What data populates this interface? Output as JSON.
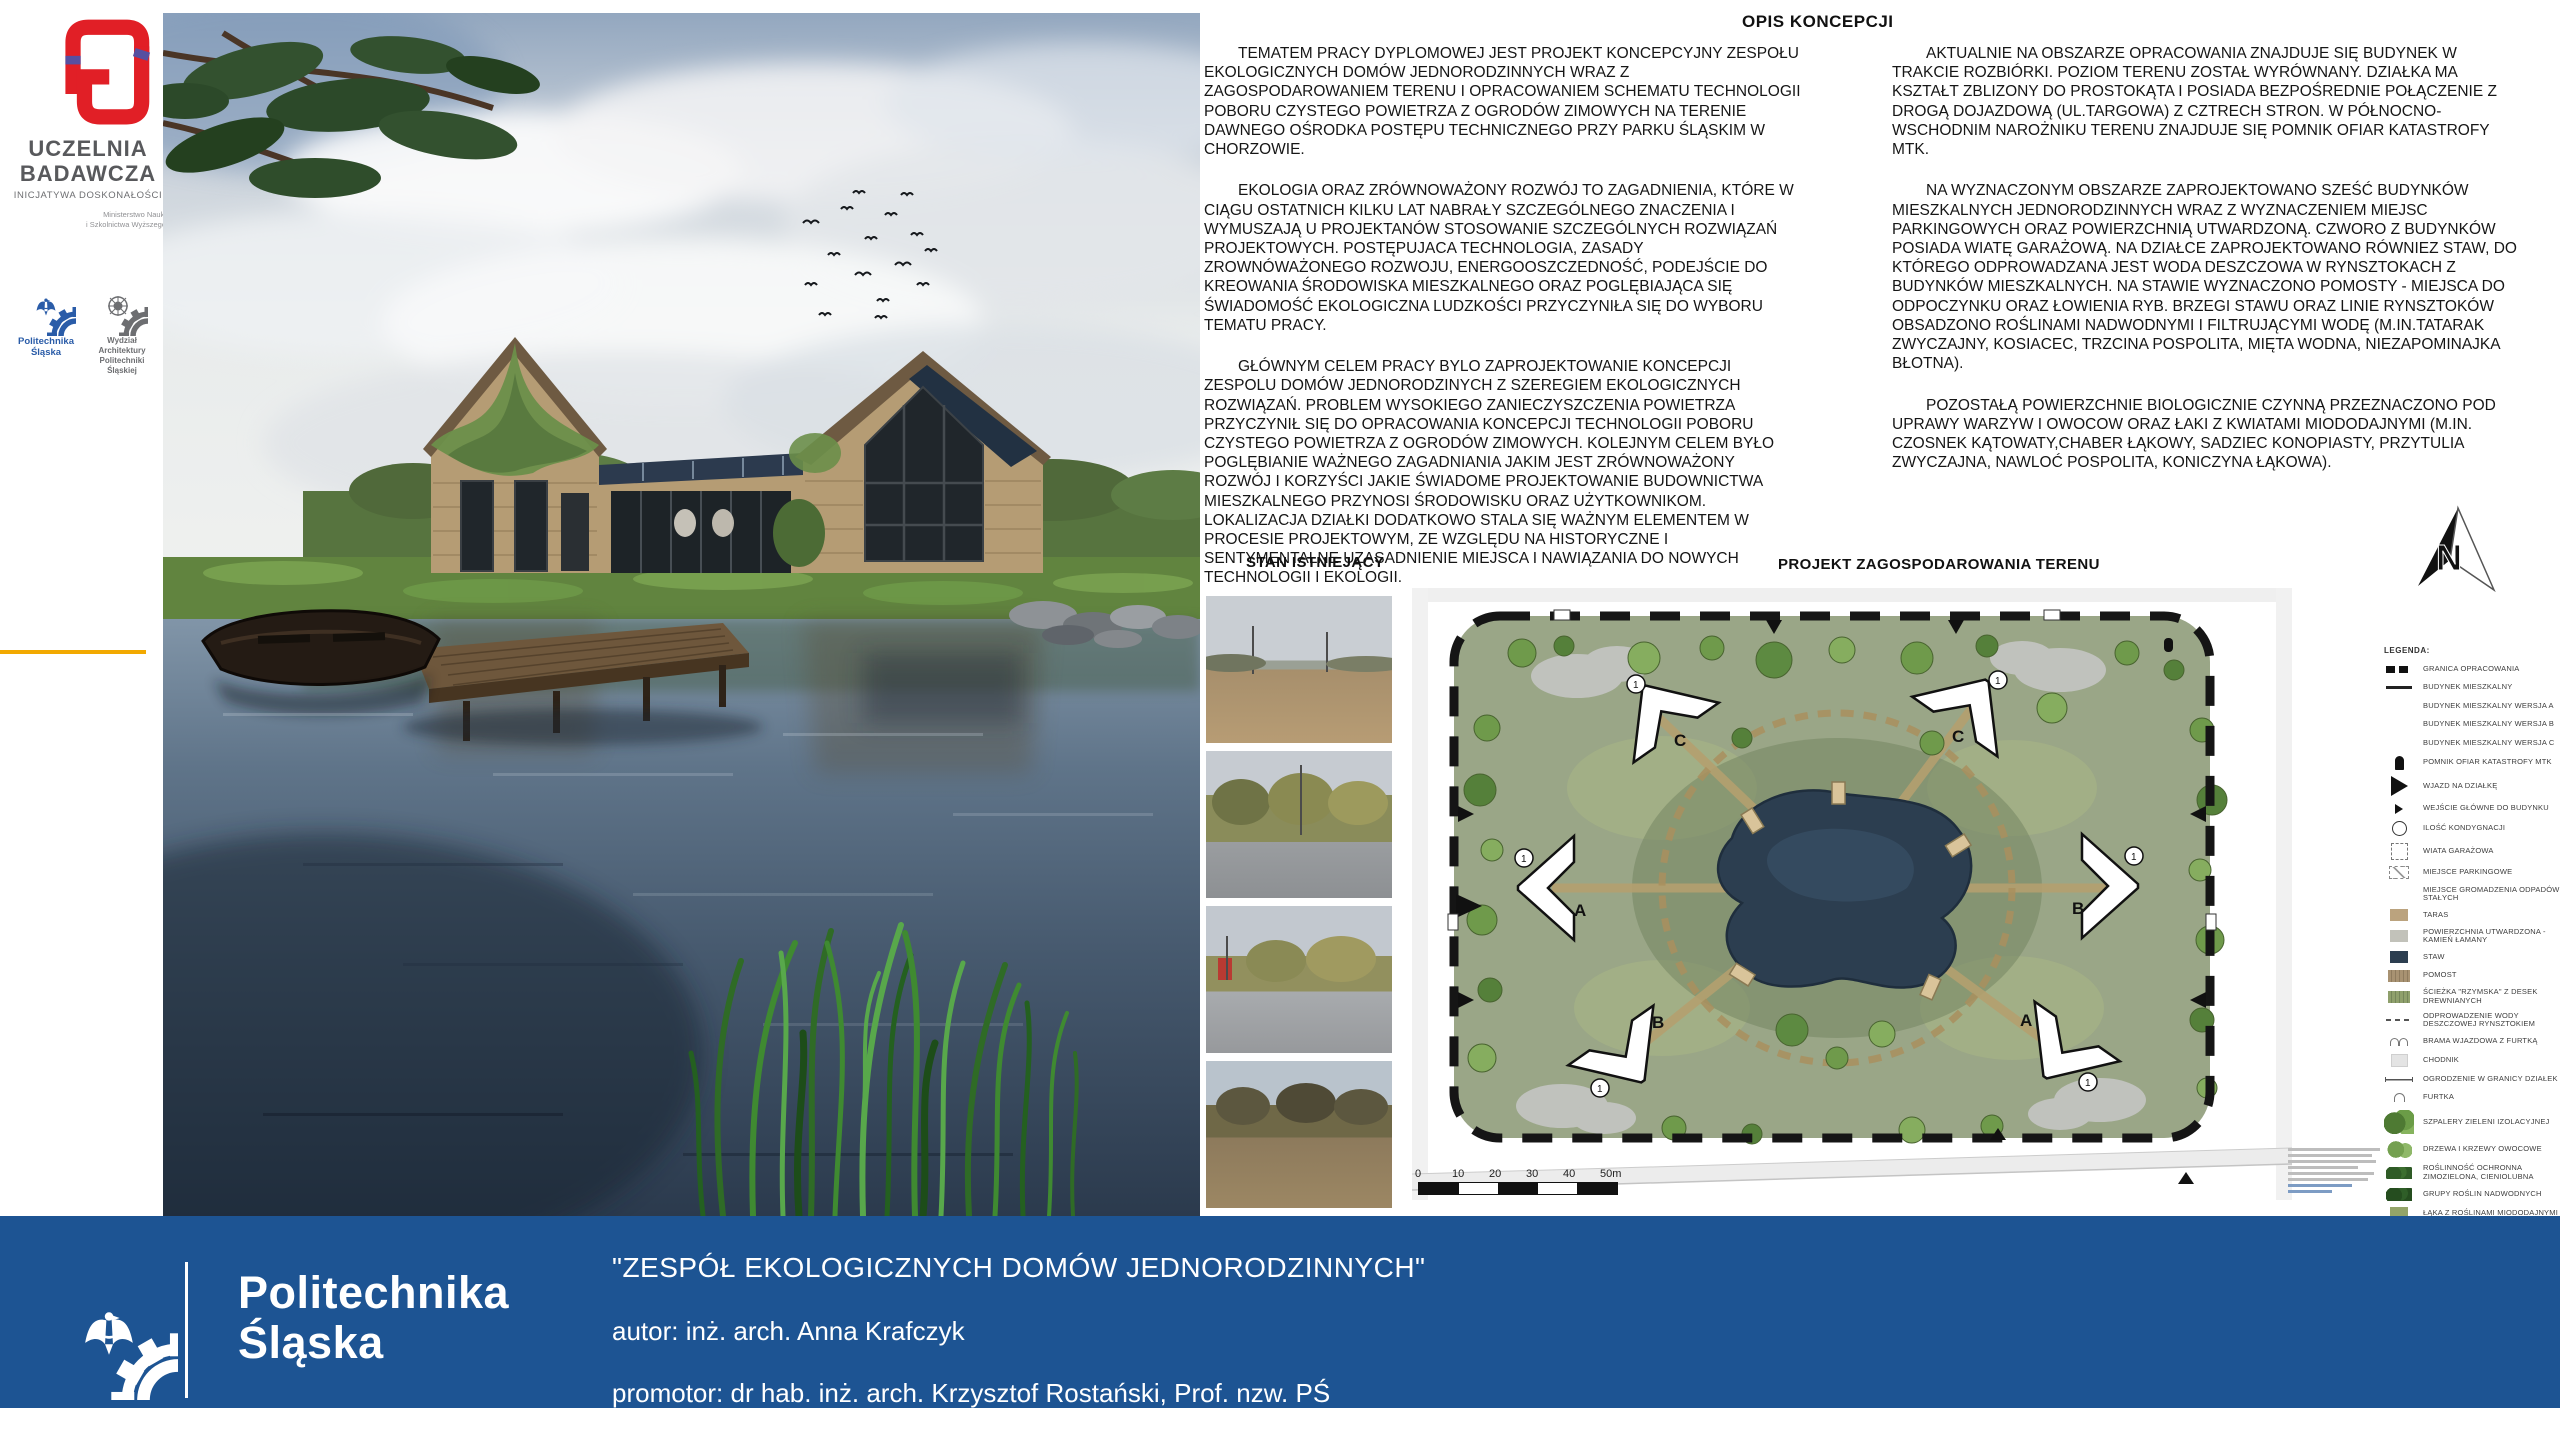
{
  "colors": {
    "footer_blue": "#1d5493",
    "accent_red": "#e11f26",
    "ps_blue": "#2a5ca8",
    "amber": "#f2a900",
    "plan_green": "#9aa687",
    "pond_navy": "#2c3e50"
  },
  "sidebar": {
    "uczelnia_line1": "UCZELNIA",
    "uczelnia_line2": "BADAWCZA",
    "uczelnia_sub": "INICJATYWA DOSKONAŁOŚCI",
    "ministry_line1": "Ministerstwo Nauki",
    "ministry_line2": "i Szkolnictwa Wyższego",
    "politechnika_label": "Politechnika Śląska",
    "wydzial_label": "Wydział Architektury Politechniki Śląskiej"
  },
  "opis": {
    "heading": "OPIS KONCEPCJI",
    "col1": [
      {
        "text": "TEMATEM PRACY DYPLOMOWEJ JEST PROJEKT KONCEPCYJNY ZESPOŁU EKOLOGICZNYCH DOMÓW JEDNORODZINNYCH WRAZ Z ZAGOSPODAROWANIEM TERENU I OPRACOWANIEM SCHEMATU TECHNOLOGII POBORU CZYSTEGO POWIETRZA Z OGRODÓW ZIMOWYCH NA TERENIE DAWNEGO OŚRODKA POSTĘPU TECHNICZNEGO PRZY PARKU ŚLĄSKIM W CHORZOWIE."
      },
      {
        "text": "EKOLOGIA ORAZ ZRÓWNOWAŻONY ROZWÓJ TO ZAGADNIENIA, KTÓRE W CIĄGU OSTATNICH KILKU LAT NABRAŁY SZCZEGÓLNEGO ZNACZENIA I WYMUSZAJĄ U PROJEKTANÓW STOSOWANIE SZCZEGÓLNYCH ROZWIĄZAŃ PROJEKTOWYCH. POSTĘPUJACA TECHNOLOGIA, ZASADY ZROWNÓWAŻONEGO ROZWOJU, ENERGOOSZCZEDNOŚĆ, PODEJŚCIE DO KREOWANIA ŚRODOWISKA MIESZKALNEGO ORAZ POGLĘBIAJĄCA SIĘ ŚWIADOMOŚĆ EKOLOGICZNA LUDZKOŚCI PRZYCZYNIŁA SIĘ DO WYBORU TEMATU PRACY."
      },
      {
        "text": "GŁÓWNYM CELEM PRACY BYLO ZAPROJEKTOWANIE KONCEPCJI ZESPOLU DOMÓW JEDNORODZINYCH Z SZEREGIEM EKOLOGICZNYCH ROZWIĄZAŃ. PROBLEM WYSOKIEGO ZANIECZYSZCZENIA POWIETRZA PRZYCZYNIŁ SIĘ DO OPRACOWANIA KONCEPCJI TECHNOLOGII POBORU CZYSTEGO POWIETRZA Z OGRODÓW ZIMOWYCH. KOLEJNYM CELEM BYŁO POGLĘBIANIE WAŻNEGO ZAGADNIANIA JAKIM JEST ZRÓWNOWAŻONY ROZWÓJ I KORZYŚCI JAKIE ŚWIADOME PROJEKTOWANIE BUDOWNICTWA MIESZKALNEGO PRZYNOSI ŚRODOWISKU ORAZ UŻYTKOWNIKOM. LOKALIZACJA DZIAŁKI DODATKOWO STALA SIĘ WAŻNYM ELEMENTEM W PROCESIE PROJEKTOWYM, ZE WZGLĘDU NA HISTORYCZNE I SENTYMENTALNE UZASADNIENIE MIEJSCA I NAWIĄZANIA DO NOWYCH TECHNOLOGII I EKOLOGII."
      }
    ],
    "col2": [
      {
        "text": "AKTUALNIE NA OBSZARZE OPRACOWANIA ZNAJDUJE SIĘ BUDYNEK W TRAKCIE ROZBIÓRKI. POZIOM TERENU ZOSTAŁ WYRÓWNANY. DZIAŁKA MA KSZTAŁT ZBLIZONY DO PROSTOKĄTA I POSIADA BEZPOŚREDNIE POŁĄCZENIE Z DROGĄ DOJAZDOWĄ (UL.TARGOWA) Z CZTRECH STRON. W PÓŁNOCNO-WSCHODNIM NAROŻNIKU TERENU ZNAJDUJE SIĘ POMNIK OFIAR KATASTROFY MTK."
      },
      {
        "text": "NA WYZNACZONYM OBSZARZE ZAPROJEKTOWANO SZEŚĆ BUDYNKÓW MIESZKALNYCH JEDNORODZINNYCH WRAZ Z WYZNACZENIEM MIEJSC PARKINGOWYCH ORAZ POWIERZCHNIĄ UTWARDZONĄ. CZWORO Z BUDYNKÓW POSIADA WIATĘ GARAŻOWĄ. NA DZIAŁCE ZAPROJEKTOWANO RÓWNIEZ STAW, DO KTÓREGO ODPROWADZANA JEST WODA DESZCZOWA W RYNSZTOKACH Z BUDYNKÓW MIESZKALNYCH. NA STAWIE WYZNACZONO POMOSTY - MIEJSCA DO ODPOCZYNKU ORAZ ŁOWIENIA RYB. BRZEGI STAWU ORAZ LINIE RYNSZTOKÓW OBSADZONO ROŚLINAMI NADWODNYMI I FILTRUJĄCYMI WODĘ (M.IN.TATARAK ZWYCZAJNY, KOSIACEC, TRZCINA POSPOLITA, MIĘTA WODNA, NIEZAPOMINAJKA BŁOTNA)."
      },
      {
        "text": "POZOSTAŁĄ POWIERZCHNIE BIOLOGICZNIE CZYNNĄ PRZEZNACZONO POD UPRAWY WARZYW I OWOCOW ORAZ ŁAKI Z KWIATAMI MIODODAJNYMI (M.IN. CZOSNEK KĄTOWATY,CHABER ŁĄKOWY, SADZIEC KONOPIASTY, PRZYTULIA ZWYCZAJNA, NAWLOĆ POSPOLITA, KONICZYNA ŁĄKOWA)."
      }
    ]
  },
  "stan": {
    "heading": "STAN ISTNIEJĄCY"
  },
  "projekt": {
    "heading": "PROJEKT ZAGOSPODAROWANIA TERENU",
    "north_label": "N",
    "floor_marker": "1",
    "buildings": [
      {
        "label": "C"
      },
      {
        "label": "C"
      },
      {
        "label": "A"
      },
      {
        "label": "B"
      },
      {
        "label": "B"
      },
      {
        "label": "A"
      }
    ],
    "scale_ticks": [
      {
        "t": "0"
      },
      {
        "t": "10"
      },
      {
        "t": "20"
      },
      {
        "t": "30"
      },
      {
        "t": "40"
      },
      {
        "t": "50m"
      }
    ]
  },
  "legend": {
    "title": "LEGENDA:",
    "items": [
      {
        "sym": "granica",
        "label": "GRANICA OPRACOWANIA"
      },
      {
        "sym": "linia",
        "label": "BUDYNEK MIESZKALNY"
      },
      {
        "sym": "lit",
        "glyph": "A",
        "label": "BUDYNEK MIESZKALNY WERSJA A"
      },
      {
        "sym": "lit",
        "glyph": "B",
        "label": "BUDYNEK MIESZKALNY WERSJA B"
      },
      {
        "sym": "lit",
        "glyph": "C",
        "label": "BUDYNEK MIESZKALNY WERSJA C"
      },
      {
        "sym": "pomnik",
        "label": "POMNIK OFIAR KATASTROFY MTK"
      },
      {
        "sym": "wjazd",
        "label": "WJAZD NA DZIAŁKĘ"
      },
      {
        "sym": "wejscie",
        "label": "WEJŚCIE GŁÓWNE DO BUDYNKU"
      },
      {
        "sym": "kond",
        "glyph": "1",
        "label": "ILOŚĆ KONDYGNACJI"
      },
      {
        "sym": "wiata",
        "label": "WIATA GARAŻOWA"
      },
      {
        "sym": "parking",
        "label": "MIEJSCE PARKINGOWE"
      },
      {
        "sym": "odpady",
        "glyph": "#",
        "label": "MIEJSCE GROMADZENIA ODPADÓW STAŁYCH"
      },
      {
        "sym": "taras",
        "label": "TARAS"
      },
      {
        "sym": "utward",
        "label": "POWIERZCHNIA UTWARDZONA - KAMIEŃ ŁAMANY"
      },
      {
        "sym": "staw",
        "label": "STAW"
      },
      {
        "sym": "pomost",
        "label": "POMOST"
      },
      {
        "sym": "sciezka",
        "label": "ŚCIEŻKA \"RZYMSKA\" Z DESEK DREWNIANYCH"
      },
      {
        "sym": "rynsztok",
        "label": "ODPROWADZENIE WODY DESZCZOWEJ RYNSZTOKIEM"
      },
      {
        "sym": "brama",
        "label": "BRAMA WJAZDOWA Z FURTKĄ"
      },
      {
        "sym": "chodnik",
        "label": "CHODNIK"
      },
      {
        "sym": "ogrodzenie",
        "label": "OGRODZENIE W GRANICY DZIAŁEK"
      },
      {
        "sym": "furtka",
        "label": "FURTKA"
      },
      {
        "sym": "szpalery",
        "label": "SZPALERY ZIELENI IZOLACYJNEJ"
      },
      {
        "sym": "drzewa",
        "label": "DRZEWA I KRZEWY OWOCOWE"
      },
      {
        "sym": "zimozielona",
        "label": "ROŚLINNOŚĆ OCHRONNA ZIMOZIELONA, CIENIOLUBNA"
      },
      {
        "sym": "nadwodne",
        "label": "GRUPY ROŚLIN NADWODNYCH"
      },
      {
        "sym": "laka",
        "label": "ŁĄKA Z ROŚLINAMI MIODODAJNYMI"
      }
    ]
  },
  "footer": {
    "logo_line1": "Politechnika",
    "logo_line2": "Śląska",
    "title": "\"ZESPÓŁ EKOLOGICZNYCH DOMÓW JEDNORODZINNYCH\"",
    "author": "autor: inż. arch. Anna Krafczyk",
    "promoter": "promotor: dr hab. inż. arch. Krzysztof Rostański, Prof. nzw. PŚ"
  }
}
